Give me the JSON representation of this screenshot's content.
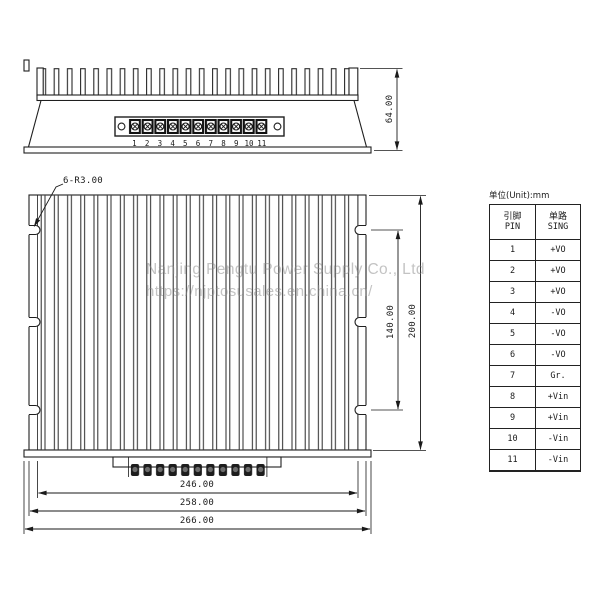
{
  "watermark": {
    "line1": "Nanjing Pengtu Power Supply Co., Ltd",
    "line2": "https://njptosusales.en.china.cn/"
  },
  "top_view": {
    "dim_height": "64.00",
    "pin_numbers": [
      "1",
      "2",
      "3",
      "4",
      "5",
      "6",
      "7",
      "8",
      "9",
      "10",
      "11"
    ]
  },
  "front_view": {
    "slot_label": "6-R3.00",
    "dim_slot_span": "140.00",
    "dim_height": "200.00",
    "dim_fins_width": "246.00",
    "dim_body_width": "258.00",
    "dim_overall_width": "266.00"
  },
  "pin_table": {
    "unit_label": "单位(Unit):mm",
    "col1_line1": "引脚",
    "col1_line2": "PIN",
    "col2_line1": "单路",
    "col2_line2": "SING",
    "rows": [
      {
        "pin": "1",
        "sing": "+VO"
      },
      {
        "pin": "2",
        "sing": "+VO"
      },
      {
        "pin": "3",
        "sing": "+VO"
      },
      {
        "pin": "4",
        "sing": "-VO"
      },
      {
        "pin": "5",
        "sing": "-VO"
      },
      {
        "pin": "6",
        "sing": "-VO"
      },
      {
        "pin": "7",
        "sing": "Gr."
      },
      {
        "pin": "8",
        "sing": "+Vin"
      },
      {
        "pin": "9",
        "sing": "+Vin"
      },
      {
        "pin": "10",
        "sing": "-Vin"
      },
      {
        "pin": "11",
        "sing": "-Vin"
      }
    ]
  },
  "colors": {
    "line": "#1a1a1a",
    "watermark": "#878787"
  }
}
